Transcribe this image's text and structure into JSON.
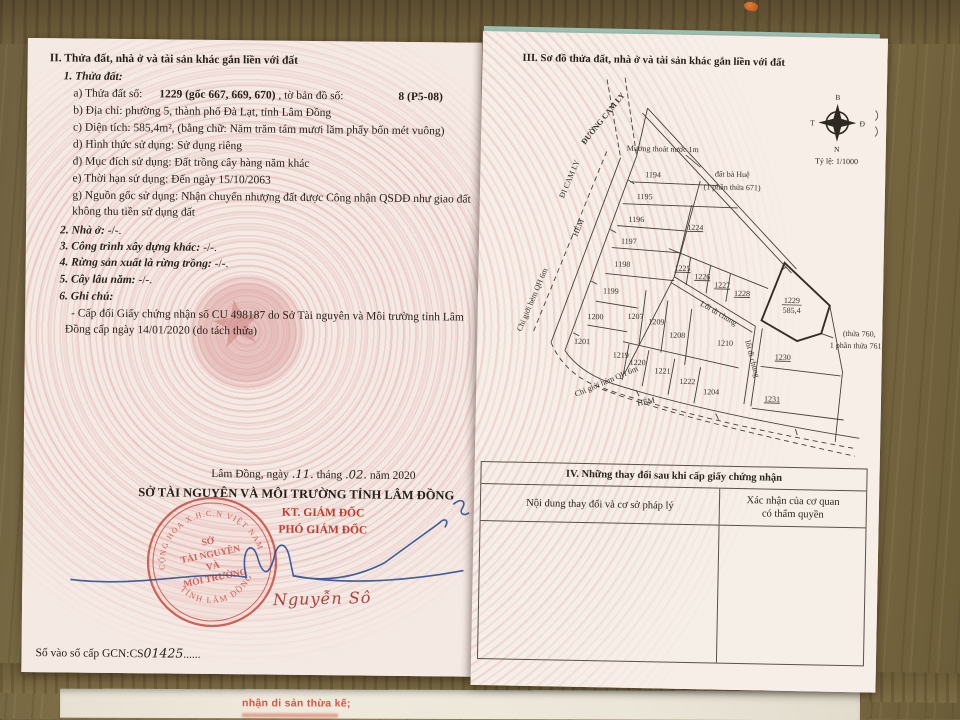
{
  "colors": {
    "red_ink": "#c03a2e",
    "seal_red": "#c84a40",
    "blue_ink": "#2d4e96",
    "paper_pink": "#f5e9e4",
    "wood_brown": "#83734a"
  },
  "icons": {
    "emblem_star": "★"
  },
  "bottom_sheet": {
    "red_text": "nhận di sản thừa kế;"
  },
  "page_left": {
    "section_title": "II. Thửa đất, nhà ở và tài sản khác gắn liền với đất",
    "plot": {
      "heading": "1. Thửa đất:",
      "a_label": "a) Thửa đất số:",
      "a_number": "1229 (gốc 667, 669, 670)",
      "a_sep": ", tờ bản đồ số:",
      "a_map_number": "8 (P5-08)",
      "b": "b) Địa chỉ:  phường 5, thành phố Đà Lạt, tỉnh Lâm Đồng",
      "c": "c) Diện tích: 585,4m², (bằng chữ: Năm trăm tám mươi lăm phẩy bốn mét vuông)",
      "d": "d) Hình thức sử dụng:  Sử dụng riêng",
      "dd": "đ) Mục đích sử dụng:  Đất trồng cây hàng năm khác",
      "e": "e) Thời hạn sử dụng:  Đến ngày 15/10/2063",
      "g1": "g) Nguồn gốc sử dụng:  Nhận chuyển nhượng đất được Công nhận QSDĐ như giao đất",
      "g2": "không thu tiền sử dụng đất"
    },
    "item2_label": "2. Nhà ở:",
    "item2_value": "-/-.",
    "item3_label": "3. Công trình xây dựng khác:",
    "item3_value": "-/-.",
    "item4_label": "4. Rừng sản xuất là rừng trồng:",
    "item4_value": "-/-.",
    "item5_label": "5. Cây lâu năm:",
    "item5_value": "-/-.",
    "item6_label": "6. Ghi chú:",
    "note_line1": "- Cấp đổi Giấy chứng nhận số CU 498187 do Sở Tài nguyên và Môi trường tỉnh Lâm",
    "note_line2": "Đồng cấp ngày 14/01/2020 (do tách thửa)",
    "date_prefix": "Lâm Đồng, ngày",
    "date_day": ".11.",
    "date_mid": "tháng",
    "date_month": ".02.",
    "date_suffix": "năm 2020",
    "issuer": "SỞ TÀI NGUYÊN VÀ MÔI TRƯỜNG TỈNH LÂM ĐỒNG",
    "signer_title1": "KT. GIÁM ĐỐC",
    "signer_title2": "PHÓ GIÁM ĐỐC",
    "signer_name": "Nguyễn Sô",
    "seal": {
      "top_arc": "CỘNG HÒA X.H.C.N VIỆT NAM",
      "line1": "SỞ",
      "line2": "TÀI NGUYÊN",
      "line3": "VÀ",
      "line4": "MÔI TRƯỜNG",
      "bottom_arc": "TỈNH LÂM ĐỒNG"
    },
    "book_label": "Số vào sổ cấp GCN:",
    "book_prefix": "CS",
    "book_digits": "01425",
    "book_dots": "......"
  },
  "page_right": {
    "section_title": "III. Sơ đồ thửa đất, nhà ở và tài sản khác gắn liền với đất",
    "compass": {
      "n": "B",
      "e": "Đ",
      "s": "N",
      "w": "T"
    },
    "scale": "Tỷ lệ: 1/1000",
    "map": {
      "road_label": "ĐƯỜNG CAM LY",
      "road_label2": "ĐI CAM LY",
      "alley_left": "HẺM",
      "alley_bottom": "HẺM",
      "boundary_left": "Chỉ giới hẻm QH 6m",
      "boundary_bottom": "Chỉ giới hẻm QH 6m",
      "drain_label": "Mương thoát nước 1m",
      "neighbor_top1": "đất bà Huệ",
      "neighbor_top2": "(1 phần thửa 671)",
      "common_path1": "Lối đi chung",
      "common_path2": "lối đi chung",
      "neighbor_right1": "(thửa 760,",
      "neighbor_right2": "1 phần thửa 761)",
      "main_parcel": {
        "number": "1229",
        "area": "585,4"
      },
      "parcels": {
        "p1194": "1194",
        "p1195": "1195",
        "p1196": "1196",
        "p1197": "1197",
        "p1198": "1198",
        "p1199": "1199",
        "p1200": "1200",
        "p1201": "1201",
        "p1207": "1207",
        "p1209": "1209",
        "p1208": "1208",
        "p1210": "1210",
        "p1219": "1219",
        "p1220": "1220",
        "p1221": "1221",
        "p1222": "1222",
        "p1204": "1204",
        "p1224": "1224",
        "p1225": "1225",
        "p1226": "1226",
        "p1227": "1227",
        "p1228": "1228",
        "p1230": "1230",
        "p1231": "1231"
      }
    },
    "section4": {
      "title": "IV. Những thay đổi sau khi cấp giấy chứng nhận",
      "col1": "Nội dung thay đổi và cơ sở pháp lý",
      "col2_line1": "Xác nhận của cơ quan",
      "col2_line2": "có thẩm quyền"
    }
  }
}
